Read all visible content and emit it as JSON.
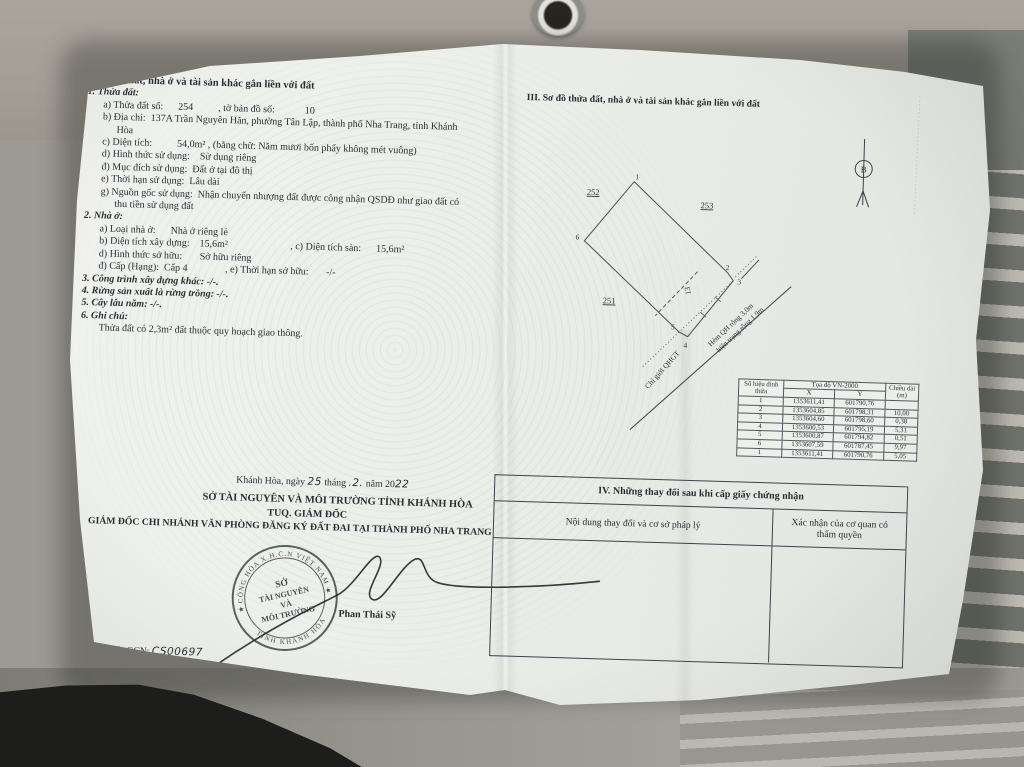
{
  "colors": {
    "paper": "#eef0ec",
    "ink": "#2b2c33",
    "seal": "#454e49",
    "fabric_top": "#a49e97",
    "fabric_stripe_dark": "#6f716b",
    "fabric_stripe_light": "#bcb9b1"
  },
  "left": {
    "heading": "II. Thửa đất, nhà ở và tài sản khác gắn liền với đất",
    "s1_heading": "1. Thửa đất:",
    "s1_lines": [
      "a) Thửa đất số:      254          , tờ bản đồ số:            10",
      "b) Địa chỉ:  137A Trần Nguyên Hãn, phường Tân Lập, thành phố Nha Trang, tỉnh Khánh",
      "Hòa",
      "c) Diện tích:          54,0m² , (bằng chữ: Năm mươi bốn phẩy không mét vuông)",
      "d) Hình thức sử dụng:    Sử dụng riêng",
      "đ) Mục đích sử dụng:  Đất ở tại đô thị",
      "e) Thời hạn sử dụng:  Lâu dài",
      "g) Nguồn gốc sử dụng:  Nhận chuyển nhượng đất được công nhận QSDĐ như giao đất có",
      "thu tiền sử dụng đất"
    ],
    "s2_heading": "2. Nhà ở:",
    "s2_lines": [
      "a) Loại nhà ở:      Nhà ở riêng lẻ",
      "b) Diện tích xây dựng:    15,6m²                         , c) Diện tích sàn:      15,6m²",
      "d) Hình thức sở hữu:       Sở hữu riêng",
      "đ) Cấp (Hạng):  Cấp 4               , e) Thời hạn sở hữu:       -/-"
    ],
    "item3": "3. Công trình xây dựng khác: -/-.",
    "item4": "4. Rừng sản xuất là rừng trồng: -/-.",
    "item5": "5. Cây lâu năm: -/-.",
    "item6": "6. Ghi chú:",
    "note": "Thửa đất có 2,3m² đất thuộc quy hoạch giao thông."
  },
  "map": {
    "heading": "III. Sơ đồ thửa đất, nhà ở và tài sản khác gắn liền với đất",
    "north": "B",
    "adjacent": [
      "252",
      "253",
      "251"
    ],
    "vertices": [
      "1",
      "2",
      "3",
      "4",
      "5",
      "6"
    ],
    "parcel_no": "13",
    "qhgt": "Chỉ giới QHGT",
    "road1": "Hẻm QH rộng 3,0m",
    "road2": "hiện trạng rộng 1,9m"
  },
  "coords": {
    "corner": "Số hiệu đỉnh thửa",
    "title": "Tọa độ VN-2000",
    "x": "X",
    "y": "Y",
    "len": "Chiều dài (m)",
    "rows": [
      {
        "id": "1",
        "x": "1353611,41",
        "y": "601790,76",
        "len": ""
      },
      {
        "id": "2",
        "x": "1353604,85",
        "y": "601798,31",
        "len": "10,00"
      },
      {
        "id": "3",
        "x": "1353604,60",
        "y": "601798,60",
        "len": "0,38"
      },
      {
        "id": "4",
        "x": "1353600,53",
        "y": "601795,19",
        "len": "5,31"
      },
      {
        "id": "5",
        "x": "1353600,87",
        "y": "601794,82",
        "len": "0,51"
      },
      {
        "id": "6",
        "x": "1353607,59",
        "y": "601787,45",
        "len": "9,97"
      },
      {
        "id": "1",
        "x": "1353611,41",
        "y": "601790,76",
        "len": "5,05"
      }
    ]
  },
  "changes": {
    "title": "IV. Những thay đổi sau khi cấp giấy chứng nhận",
    "col_content": "Nội dung thay đổi và cơ sở pháp lý",
    "col_confirm": "Xác nhận của cơ quan có thẩm quyền"
  },
  "sign": {
    "place_prefix": "Khánh Hòa, ngày",
    "day": "25",
    "thang": "tháng",
    "month": ".2.",
    "nam20": "năm 20",
    "year": "22",
    "org": "SỞ TÀI NGUYÊN VÀ MÔI TRƯỜNG TỈNH KHÁNH HÒA",
    "tuq": "TUQ. GIÁM ĐỐC",
    "director": "GIÁM ĐỐC CHI NHÁNH VĂN PHÒNG ĐĂNG KÝ ĐẤT ĐAI TẠI THÀNH PHỐ NHA TRANG",
    "signer": "Phan Thái Sỹ",
    "seal_top": "CỘNG HÒA X.H.C.N VIỆT NAM",
    "seal_bottom": "TỈNH KHÁNH HÒA",
    "seal_c1": "SỞ",
    "seal_c2": "TÀI NGUYÊN",
    "seal_c3": "VÀ",
    "seal_c4": "MÔI TRƯỜNG",
    "gcn_label": "Số vào sổ cấp GCN:",
    "gcn_no": "CS00697"
  }
}
